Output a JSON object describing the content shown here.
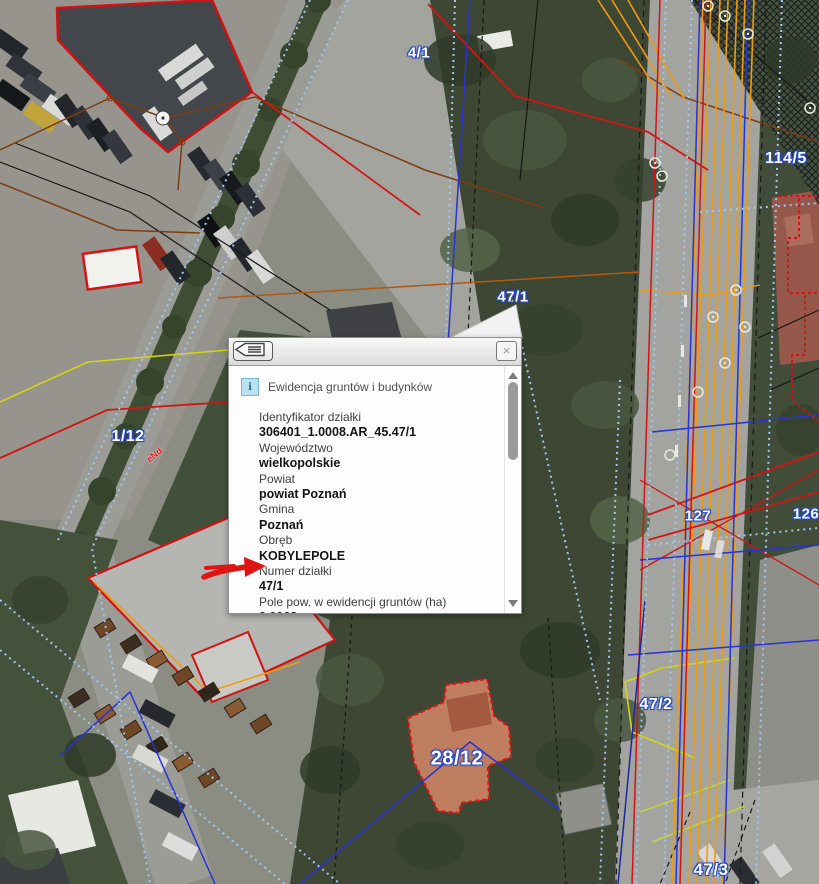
{
  "map": {
    "parcel_labels": [
      {
        "text": "4/1"
      },
      {
        "text": "114/5"
      },
      {
        "text": "47/1"
      },
      {
        "text": "1/12"
      },
      {
        "text": "127"
      },
      {
        "text": "126"
      },
      {
        "text": "47/2"
      },
      {
        "text": "28/12"
      },
      {
        "text": "47/3"
      }
    ],
    "utility_labels": [
      {
        "text": "eNd"
      }
    ],
    "colors": {
      "boundary_red": "#d21414",
      "utility_orange": "#ef9b0f",
      "utility_blue": "#2633d6",
      "cadastral_dotted_blue": "#9fc7f2",
      "gas_yellow": "#d4d415",
      "label_outline_blue": "#2749c4"
    }
  },
  "popup": {
    "title": "Ewidencja gruntów i budynków",
    "info_icon": "i",
    "close_icon": "×",
    "fields": [
      {
        "label": "Identyfikator działki",
        "value": "306401_1.0008.AR_45.47/1"
      },
      {
        "label": "Województwo",
        "value": "wielkopolskie"
      },
      {
        "label": "Powiat",
        "value": "powiat Poznań"
      },
      {
        "label": "Gmina",
        "value": "Poznań"
      },
      {
        "label": "Obręb",
        "value": "KOBYLEPOLE"
      },
      {
        "label": "Numer działki",
        "value": "47/1"
      },
      {
        "label": "Pole pow. w ewidencji gruntów (ha)",
        "value": "0.0968"
      },
      {
        "label": "Grupa rejestrowa",
        "value": "7"
      },
      {
        "label": "Oznaczenie użytku",
        "value": ""
      }
    ]
  }
}
